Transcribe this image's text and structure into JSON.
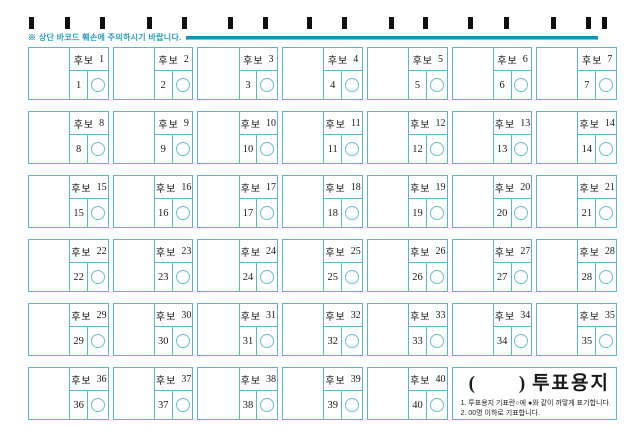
{
  "colors": {
    "cell_border": "#58b6c8",
    "accent_line": "#1095b4",
    "notice_text": "#2c9db9",
    "barcode_mark": "#101010",
    "text": "#1a1a1a"
  },
  "barcode": {
    "marks_x": [
      29,
      65,
      100,
      147,
      182,
      228,
      263,
      307,
      342,
      389,
      423,
      468,
      504,
      551,
      586,
      602
    ]
  },
  "notice": {
    "text": "※ 상단 바코드 훼손에 주의하시기 바랍니다."
  },
  "ballot": {
    "candidate_prefix": "후보",
    "candidates": [
      1,
      2,
      3,
      4,
      5,
      6,
      7,
      8,
      9,
      10,
      11,
      12,
      13,
      14,
      15,
      16,
      17,
      18,
      19,
      20,
      21,
      22,
      23,
      24,
      25,
      26,
      27,
      28,
      29,
      30,
      31,
      32,
      33,
      34,
      35,
      36,
      37,
      38,
      39,
      40
    ]
  },
  "title_box": {
    "paren_open": "(",
    "paren_close": ")",
    "title_label": "투표용지",
    "instructions": [
      "1. 투표용지 기표란○에 ●와 같이 까맣게 표기합니다.",
      "2. 00명 이하로 기표합니다."
    ]
  }
}
